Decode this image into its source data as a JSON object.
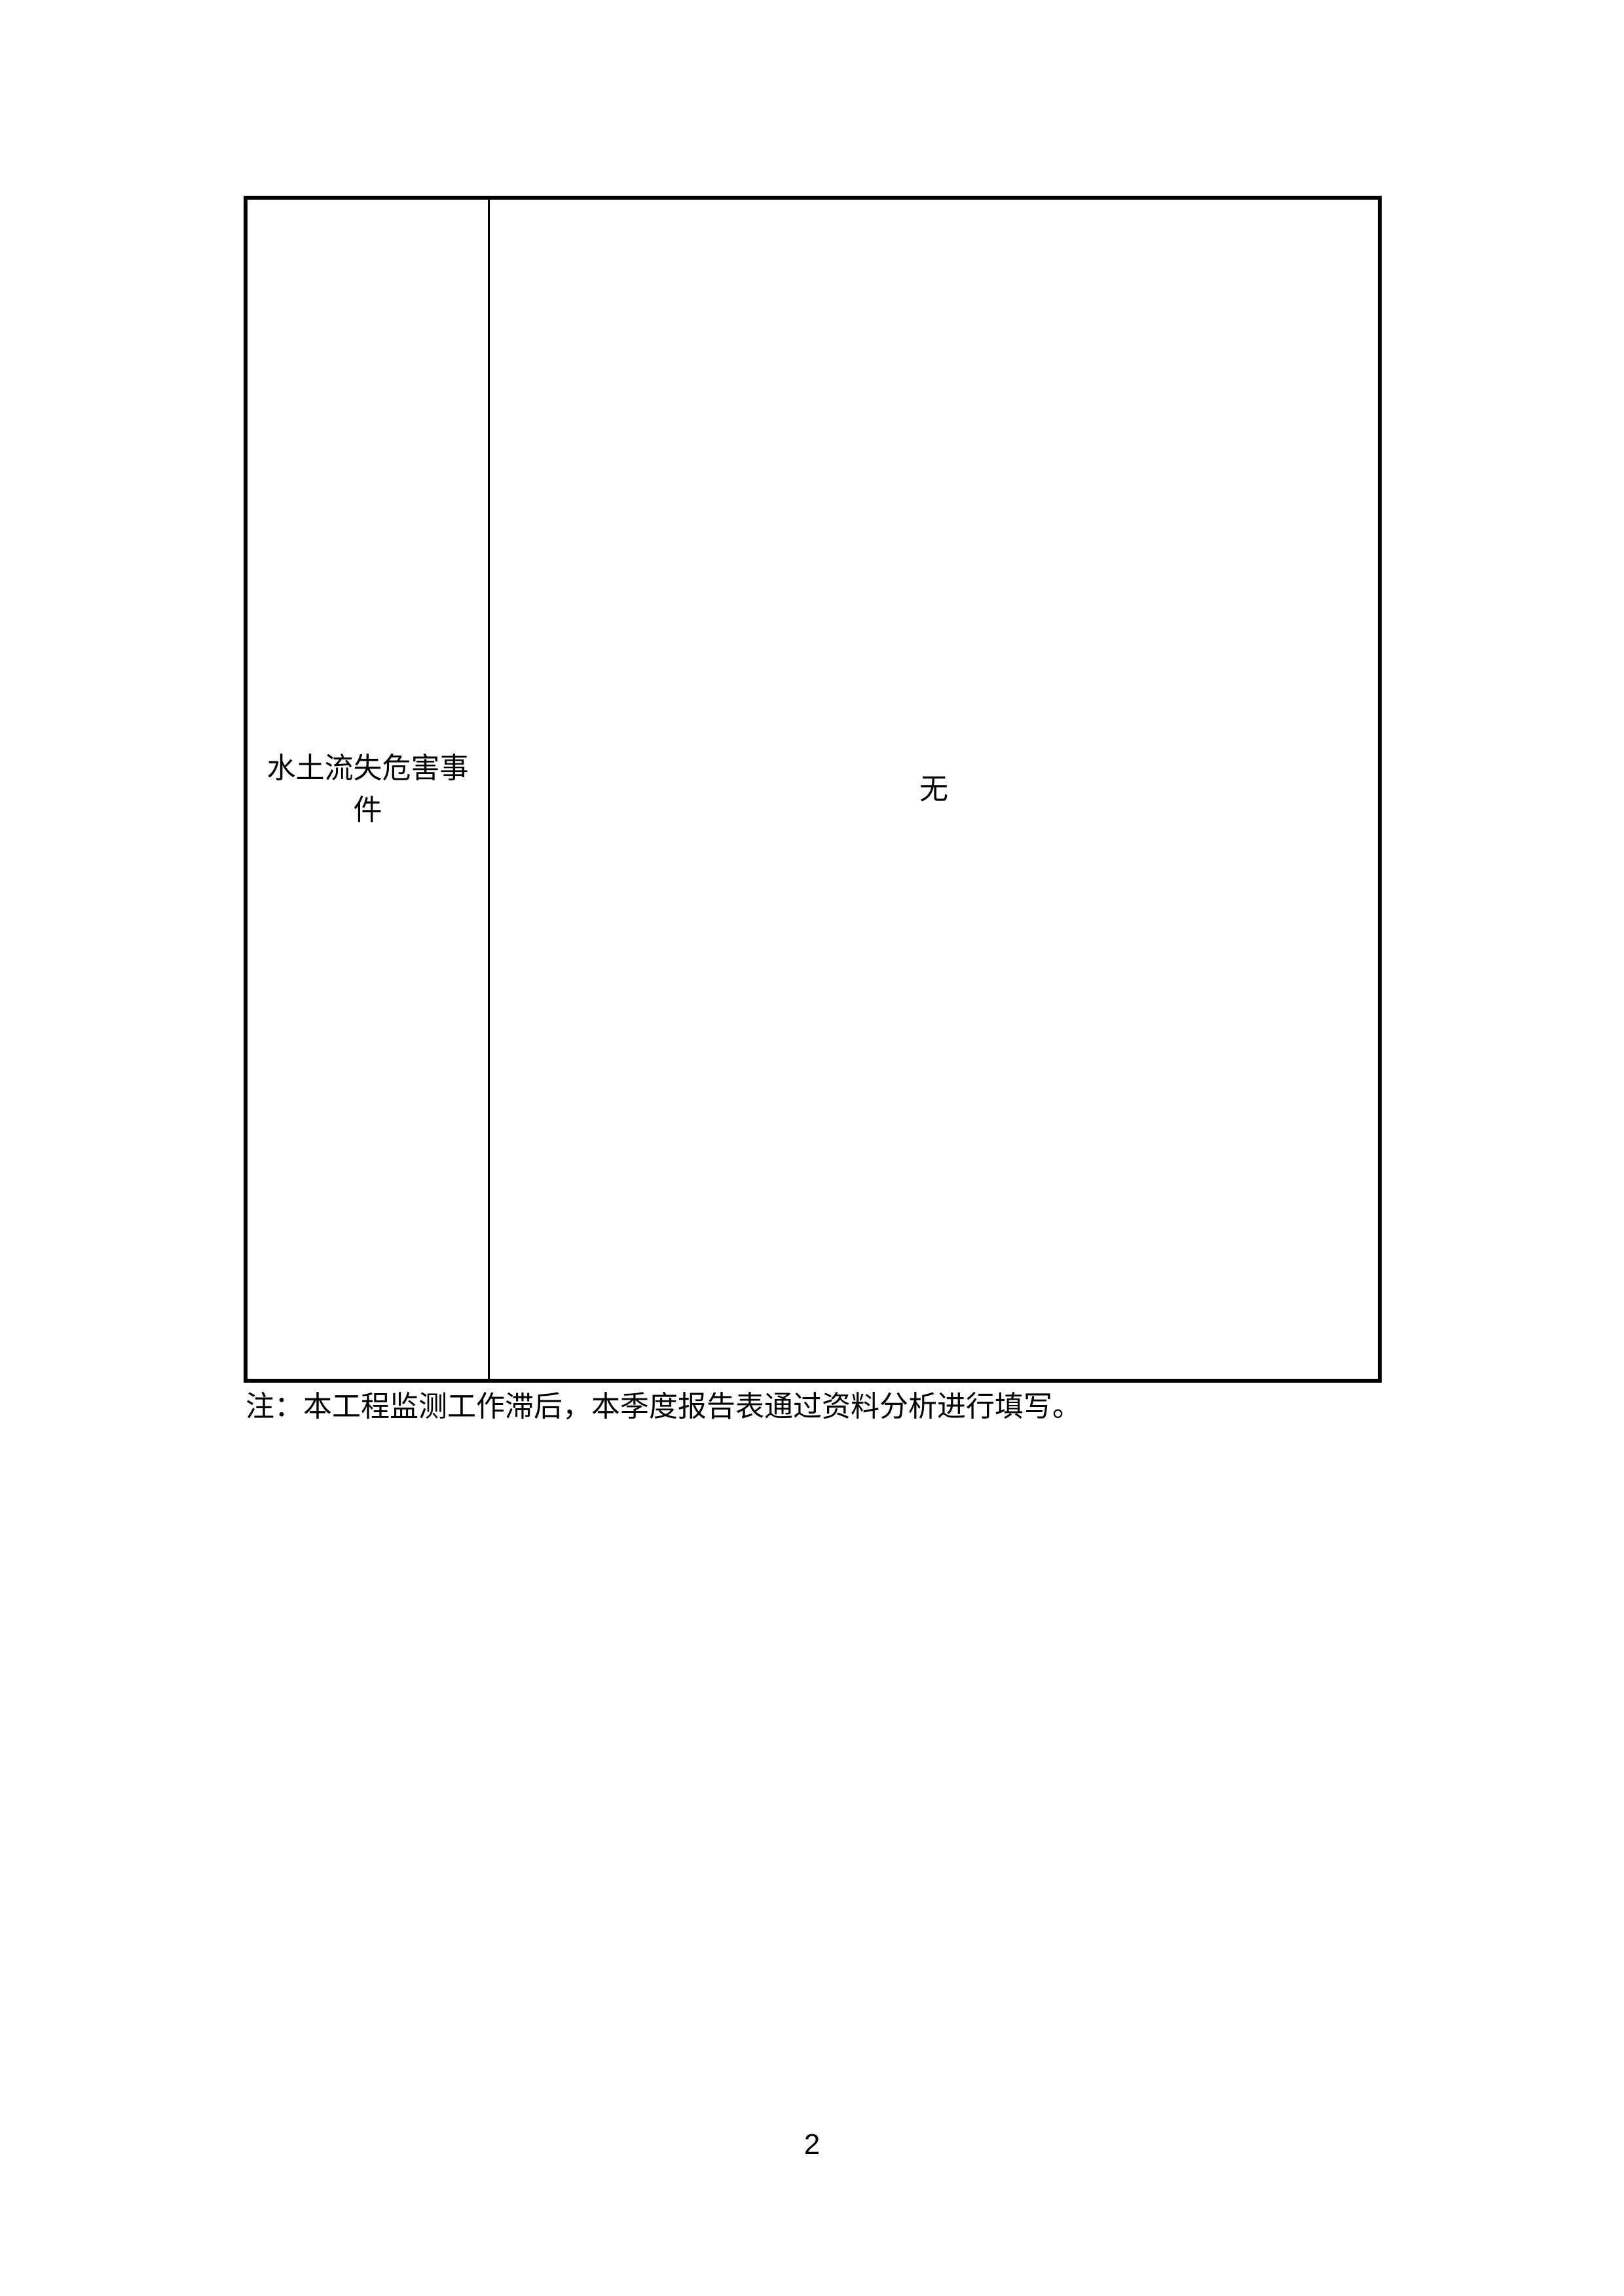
{
  "document": {
    "table": {
      "rows": [
        {
          "label": "水土流失危害事件",
          "value": "无"
        }
      ]
    },
    "note": "注：本工程监测工作滞后，本季度报告表通过资料分析进行填写。",
    "footer": {
      "page_number": "2"
    },
    "colors": {
      "background": "#ffffff",
      "text": "#000000",
      "border": "#000000"
    }
  }
}
